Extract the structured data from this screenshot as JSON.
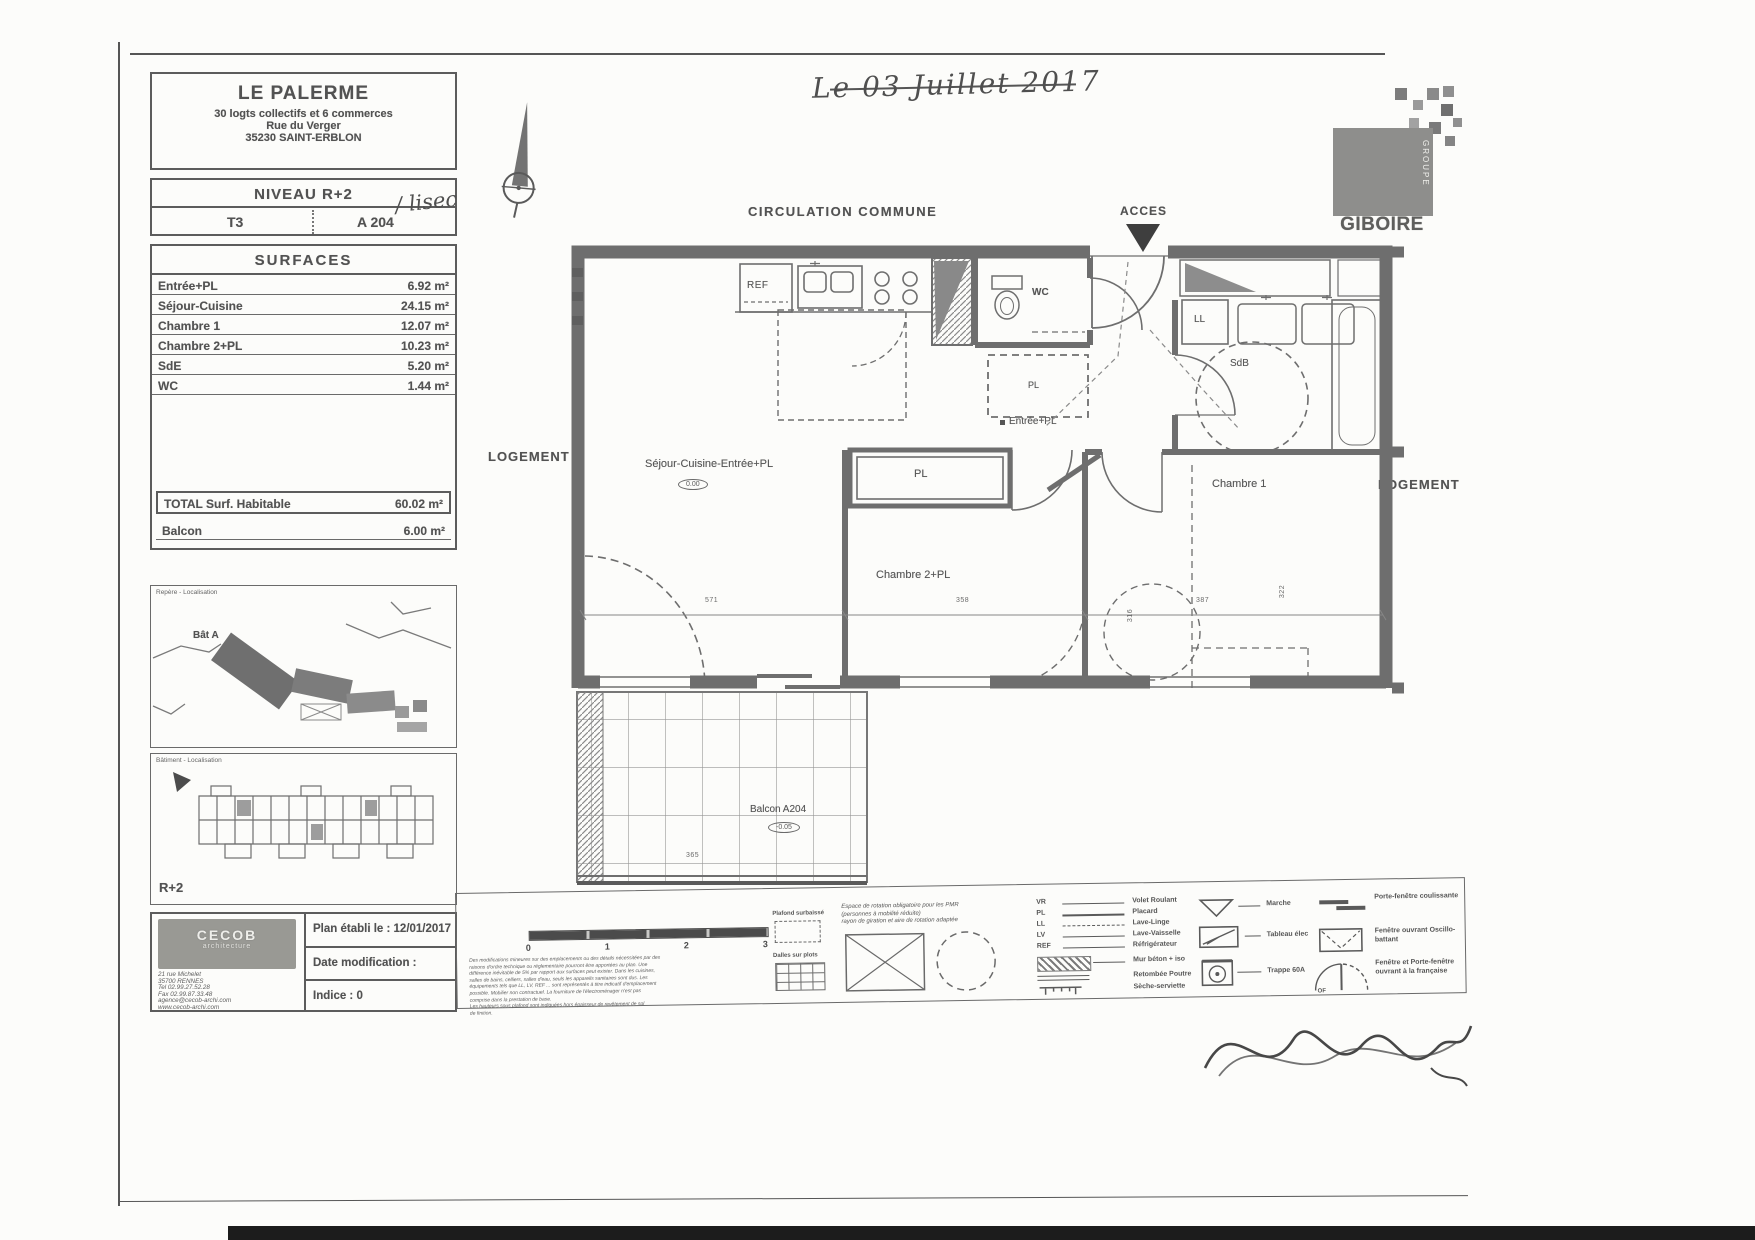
{
  "scan": {
    "handwritten_date": "Le 03 Juillet 2017",
    "unit_note": "/ lisec"
  },
  "title_block": {
    "project": "LE PALERME",
    "subtitle": "30 logts collectifs et 6 commerces",
    "street": "Rue du Verger",
    "city": "35230 SAINT-ERBLON",
    "level": "NIVEAU R+2",
    "unit_type": "T3",
    "unit_number": "A 204"
  },
  "surfaces": {
    "title": "SURFACES",
    "rows": [
      {
        "label": "Entrée+PL",
        "value": "6.92 m²"
      },
      {
        "label": "Séjour-Cuisine",
        "value": "24.15 m²"
      },
      {
        "label": "Chambre 1",
        "value": "12.07 m²"
      },
      {
        "label": "Chambre 2+PL",
        "value": "10.23 m²"
      },
      {
        "label": "SdE",
        "value": "5.20 m²"
      },
      {
        "label": "WC",
        "value": "1.44 m²"
      }
    ],
    "total_label": "TOTAL Surf. Habitable",
    "total_value": "60.02 m²",
    "balcony_label": "Balcon",
    "balcony_value": "6.00 m²"
  },
  "location_maps": {
    "upper_caption": "Repère - Localisation",
    "upper_building_label": "Bât A",
    "lower_caption": "Bâtiment - Localisation",
    "lower_level_label": "R+2"
  },
  "cartouche": {
    "logo_line1": "CECOB",
    "logo_line2": "architecture",
    "address_lines": [
      "21 rue Michelet",
      "35700 RENNES",
      "Tel 02.99.27.52.28",
      "Fax 02.99.87.33.48",
      "agence@cecob-archi.com",
      "www.cecob-archi.com"
    ],
    "established": "Plan établi le : 12/01/2017",
    "modified": "Date modification :",
    "index": "Indice : 0"
  },
  "brand": {
    "name": "GIBOIRE",
    "group": "GROUPE"
  },
  "plan": {
    "corridor_label": "CIRCULATION COMMUNE",
    "access_label": "ACCES",
    "left_neighbor": "LOGEMENT",
    "right_neighbor": "LOGEMENT",
    "rooms": {
      "sejour": "Séjour-Cuisine-Entrée+PL",
      "sejour_level": "0.00",
      "closet_main": "PL",
      "closet_hall": "PL",
      "bedroom2": "Chambre 2+PL",
      "bedroom1": "Chambre 1",
      "bathroom": "SdB",
      "wc": "WC",
      "washer": "LL",
      "fridge": "REF",
      "entry": "Entrée+PL",
      "balcony": "Balcon A204",
      "balcony_level": "-0.05"
    },
    "dimensions": [
      "571",
      "358",
      "387",
      "316",
      "322",
      "365"
    ]
  },
  "legend": {
    "scale_ticks": [
      "0",
      "1",
      "2",
      "3"
    ],
    "disclaimer_lines": [
      "Des modifications mineures sur des emplacements ou des détails nécessitées par des",
      "raisons d'ordre technique ou réglementaire pourront être apportées au plan. Une",
      "différence inévitable de 5% par rapport aux surfaces peut exister. Dans les cuisines,",
      "salles de bains, celliers, salles d'eau, seuls les appareils sanitaires sont dus. Les",
      "équipements tels que LL, LV, REF ... sont représentés à titre indicatif d'emplacement",
      "possible. Mobilier non contractuel. La fourniture de l'électroménager n'est pas",
      "comprise dans la prestation de base.",
      "Les hauteurs sous plafond sont indiquées hors épaisseur de revêtement de sol",
      "de finition."
    ],
    "pmr_lines": [
      "Espace de rotation obligatoire pour les PMR",
      "(personnes à mobilité réduite)",
      "rayon de giration et aire de rotation adaptée"
    ],
    "floor_items": [
      {
        "label": "Plafond surbaissé"
      },
      {
        "label": "Dalles sur plots"
      }
    ],
    "abbreviations": [
      {
        "abbr": "VR",
        "label": "Volet Roulant"
      },
      {
        "abbr": "PL",
        "label": "Placard"
      },
      {
        "abbr": "LL",
        "label": "Lave-Linge"
      },
      {
        "abbr": "LV",
        "label": "Lave-Vaisselle"
      },
      {
        "abbr": "REF",
        "label": "Réfrigérateur"
      }
    ],
    "material_items": [
      {
        "label": "Mur béton + iso"
      },
      {
        "label": "Retombée Poutre"
      },
      {
        "label": "Sèche-serviette"
      }
    ],
    "symbol_items": [
      {
        "label": "Marche"
      },
      {
        "label": "Tableau élec"
      },
      {
        "label": "Trappe 60A"
      }
    ],
    "window_items": [
      {
        "label": "Porte-fenêtre coulissante"
      },
      {
        "label": "Fenêtre ouvrant Oscillo-battant"
      },
      {
        "label": "Fenêtre et Porte-fenêtre ouvrant à la française"
      }
    ],
    "of_label": "OF"
  }
}
